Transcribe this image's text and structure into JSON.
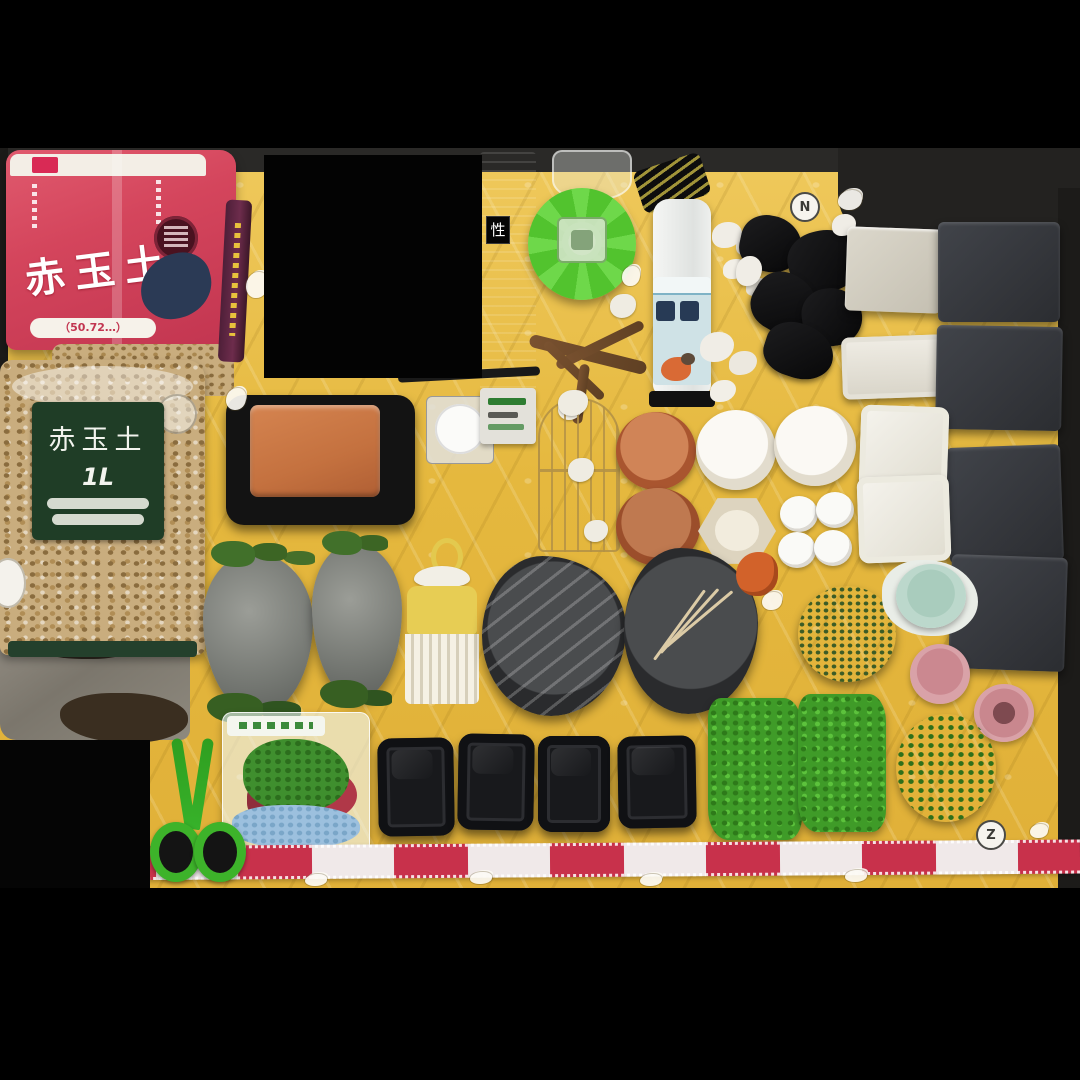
{
  "palette": {
    "blanket": "#e5b83e",
    "blanket_light": "#efc95c",
    "red_bag": "#d4455c",
    "navy": "#2b3a55",
    "green_label_bg": "#1f3d26",
    "funnel_green": "#52c32e",
    "terracotta": "#c4713f",
    "slate": "#34363b",
    "grass": "#3f9b28",
    "moss": "#557f36",
    "pink": "#d9a2a8",
    "mint": "#bcd8cc",
    "ribbon_red": "#c8314b",
    "scissors_green": "#3db32a",
    "bottle_label": "#cfe2e6",
    "driftwood": "#7a5230",
    "granule": "#c9ad7e"
  },
  "photo": {
    "description": "Flat-lay listing photo of terrarium / vivarium supplies arranged on a yellow quilted character blanket, letterboxed with black bars and one blacked-out rectangle",
    "letterbox_color": "#000000"
  },
  "red_bag": {
    "title": "赤玉土",
    "size_text": "（50.72…）"
  },
  "clear_bag": {
    "label_title": "赤玉土",
    "label_size": "1L"
  },
  "dark_package": {
    "char": "性"
  },
  "blanket": {
    "letters": [
      "N",
      "Z"
    ]
  },
  "inventory": [
    {
      "name": "akadama-soil-red-bag",
      "desc": "red bag of akadama soil with dark badge and navy print"
    },
    {
      "name": "akadama-soil-clear-bag",
      "desc": "clear bag of tan soil granules, dark green 赤玉土 1L label"
    },
    {
      "name": "opened-gray-bag",
      "desc": "opened gray foil bag with brown substrate"
    },
    {
      "name": "incense-stick-package",
      "desc": "thin purple stick package with yellow text"
    },
    {
      "name": "dark-product-package",
      "desc": "tall dark box, partially hidden by censor block"
    },
    {
      "name": "green-funnel-feeder",
      "desc": "bright green plastic cone with clear center"
    },
    {
      "name": "clear-cup",
      "desc": "transparent plastic cup at photo top edge"
    },
    {
      "name": "driftwood-branch",
      "desc": "small branching driftwood piece"
    },
    {
      "name": "white-bottle",
      "desc": "white bottle, pale blue label with dark kanji and bird art, black hang tag"
    },
    {
      "name": "white-pebbles",
      "desc": "clusters of small white stones"
    },
    {
      "name": "charcoal-pieces",
      "desc": "black charcoal / lava chunks"
    },
    {
      "name": "beige-square-tile",
      "desc": "light square paving tile"
    },
    {
      "name": "white-rect-tray",
      "desc": "white rectangular tile"
    },
    {
      "name": "dark-slate-tiles",
      "desc": "four dark gray square tiles along right edge"
    },
    {
      "name": "terracotta-tray-in-black-tray",
      "desc": "orange clay tray seated in black frame"
    },
    {
      "name": "white-round-container",
      "desc": "white round container in clear square box"
    },
    {
      "name": "small-labeled-box",
      "desc": "small white box with green label text"
    },
    {
      "name": "wire-birdcage-decor",
      "desc": "gold wire cage ornament with moss bits"
    },
    {
      "name": "terracotta-saucers",
      "desc": "two round terracotta saucers"
    },
    {
      "name": "white-round-dishes",
      "desc": "two large white round dishes"
    },
    {
      "name": "hexagon-dish",
      "desc": "beige hexagonal dish"
    },
    {
      "name": "small-white-lids",
      "desc": "four small white round lids"
    },
    {
      "name": "white-square-plates",
      "desc": "two square white plates"
    },
    {
      "name": "moss-rocks",
      "desc": "two gray rocks with green grass tufts"
    },
    {
      "name": "yellow-pick-comb",
      "desc": "yellow-handled white comb / rake with bow"
    },
    {
      "name": "black-reptile-dish-wrapped",
      "desc": "irregular black water dish in plastic wrap"
    },
    {
      "name": "black-reptile-dish-tweezers",
      "desc": "irregular black water dish with bamboo tweezers"
    },
    {
      "name": "orange-figurine",
      "desc": "small orange item"
    },
    {
      "name": "green-moss-ball",
      "desc": "round artificial moss ball"
    },
    {
      "name": "mint-pot",
      "desc": "small mint-blue pot"
    },
    {
      "name": "pink-pots",
      "desc": "two small pink pots"
    },
    {
      "name": "green-scissors",
      "desc": "green-handled scissors"
    },
    {
      "name": "artificial-plant-bag",
      "desc": "bagged artificial aquarium plant with blue gravel"
    },
    {
      "name": "black-feeding-trays",
      "desc": "four black rectangular trays in a row"
    },
    {
      "name": "grass-mats",
      "desc": "two bright green artificial grass mats"
    },
    {
      "name": "round-green-plant",
      "desc": "round green artificial plant"
    },
    {
      "name": "lace-ribbon",
      "desc": "red and white striped lace tape across the bottom"
    },
    {
      "name": "black-stick",
      "desc": "thin black stick / tool"
    }
  ]
}
